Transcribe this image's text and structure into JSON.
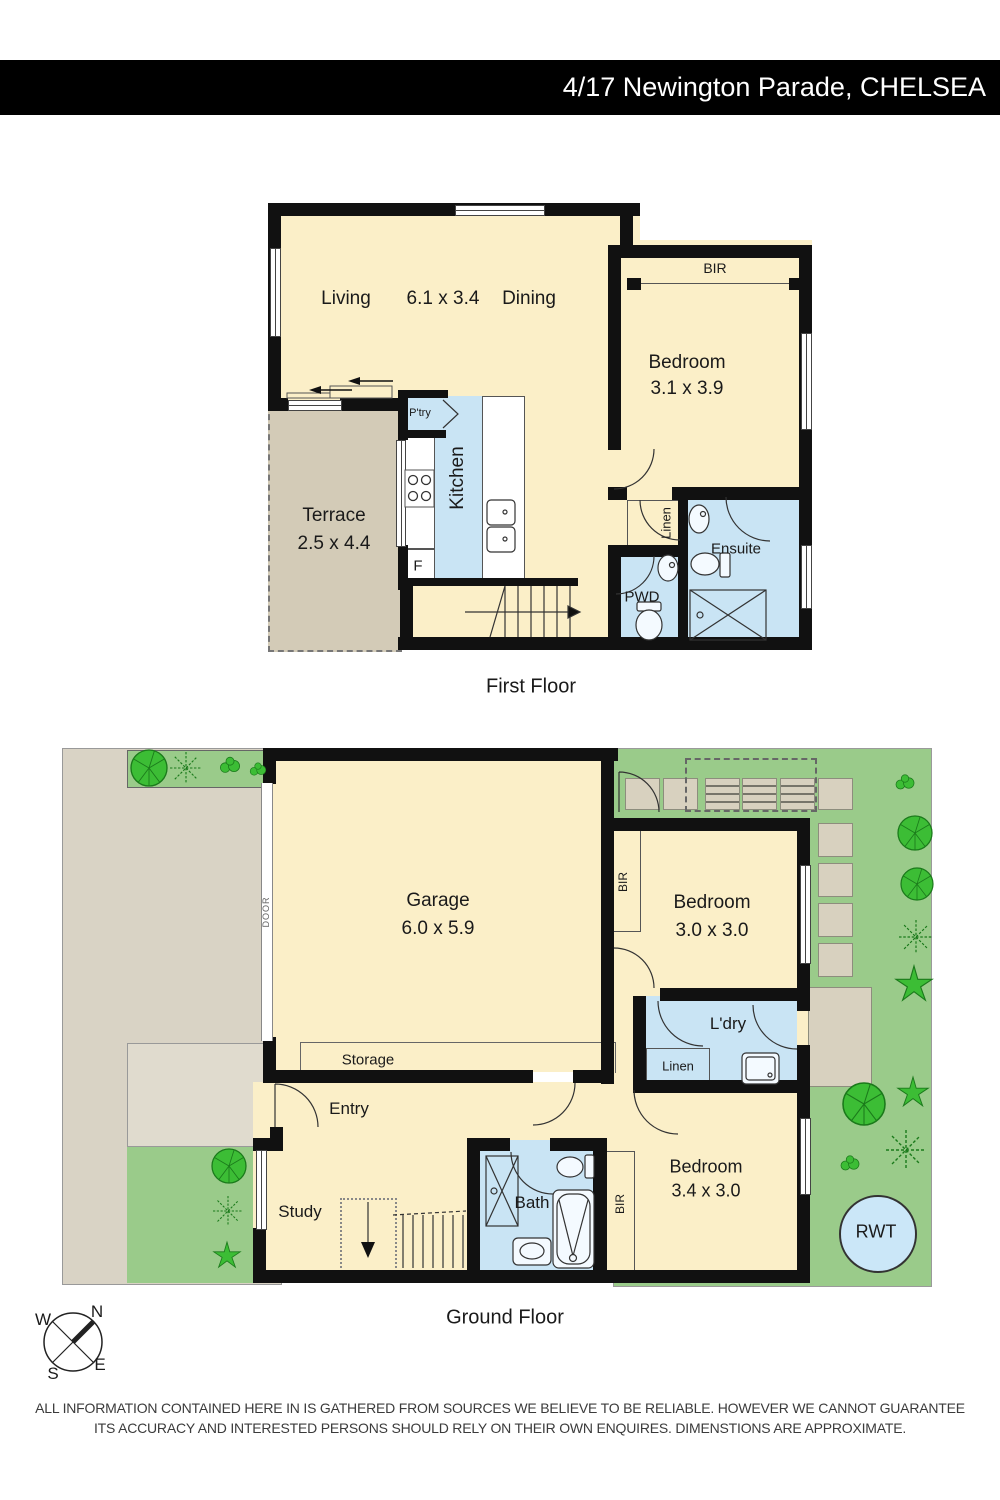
{
  "header": {
    "title": "4/17 Newington Parade, CHELSEA"
  },
  "first_floor": {
    "caption": "First Floor",
    "living": "Living",
    "living_dims": "6.1 x 3.4",
    "dining": "Dining",
    "bedroom": "Bedroom",
    "bedroom_dims": "3.1 x 3.9",
    "bir": "BIR",
    "terrace": "Terrace",
    "terrace_dims": "2.5 x 4.4",
    "pantry": "P'try",
    "kitchen": "Kitchen",
    "fridge": "F",
    "linen": "Linen",
    "ensuite": "Ensuite",
    "pwd": "PWD"
  },
  "ground_floor": {
    "caption": "Ground Floor",
    "garage": "Garage",
    "garage_dims": "6.0 x 5.9",
    "storage": "Storage",
    "door": "DOOR",
    "bedroom_rear": "Bedroom",
    "bedroom_rear_dims": "3.0 x 3.0",
    "bir_rear": "BIR",
    "laundry": "L'dry",
    "linen": "Linen",
    "entry": "Entry",
    "study": "Study",
    "bath": "Bath",
    "bir_front": "BIR",
    "bedroom_front": "Bedroom",
    "bedroom_front_dims": "3.4 x 3.0",
    "rwt": "RWT"
  },
  "compass": {
    "n": "N",
    "e": "E",
    "s": "S",
    "w": "W"
  },
  "disclaimer": {
    "line1": "ALL INFORMATION CONTAINED HERE IN IS GATHERED FROM SOURCES WE BELIEVE TO BE RELIABLE.  HOWEVER WE CANNOT GUARANTEE",
    "line2": "ITS ACCURACY AND INTERESTED PERSONS SHOULD RELY ON THEIR OWN ENQUIRES. DIMENSTIONS ARE APPROXIMATE."
  },
  "colors": {
    "wall": "#111111",
    "room": "#FBEFC8",
    "wet": "#C9E4F4",
    "terrace": "#D3CBB7",
    "drive": "#D9D3C5",
    "porch": "#E0DBCE",
    "garden": "#9ACB8A",
    "stone": "#D8D1BF",
    "plant": "#3CBD35",
    "plant_dark": "#1B7A1B",
    "rwt": "#CBE7F8",
    "header_bg": "#000000",
    "header_text": "#FFFFFF"
  }
}
